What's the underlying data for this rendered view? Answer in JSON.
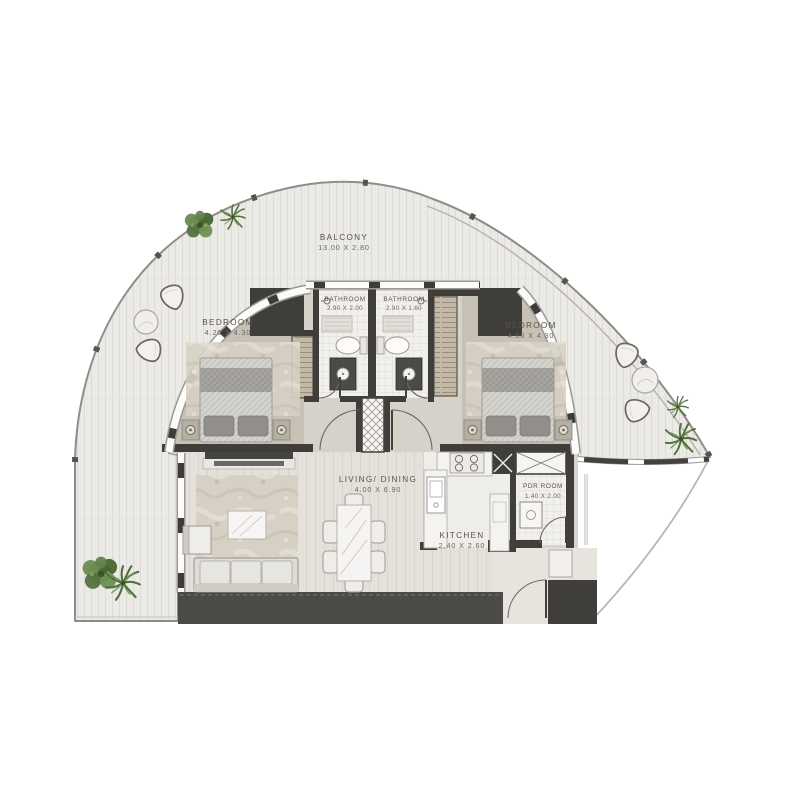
{
  "plan": {
    "rooms": [
      {
        "id": "balcony",
        "name": "BALCONY",
        "dims": "13.00 X 2.80"
      },
      {
        "id": "bedroom-left",
        "name": "BEDROOM",
        "dims": "4.20 X 4.30"
      },
      {
        "id": "bathroom-left",
        "name": "BATHROOM",
        "dims": "2.90 X 2.00"
      },
      {
        "id": "bathroom-right",
        "name": "BATHROOM",
        "dims": "2.90 X 1.60"
      },
      {
        "id": "bedroom-right",
        "name": "BEDROOM",
        "dims": "4.00 X 4.30"
      },
      {
        "id": "living-dining",
        "name": "LIVING/ DINING",
        "dims": "4.00 X 6.90"
      },
      {
        "id": "kitchen",
        "name": "KITCHEN",
        "dims": "2.40 X 2.60"
      },
      {
        "id": "pdr-room",
        "name": "PDR ROOM",
        "dims": "1.40 X 2.00"
      }
    ]
  },
  "colors": {
    "wall": "#3f3e3b",
    "outline": "#8f8d88",
    "label": "#57534d",
    "dims": "#6b6761",
    "floor-balcony": "#ebeae6",
    "floor-bedroom": "#c7c0b5",
    "floor-hall": "#d6d1c9",
    "floor-living": "#e4e1da",
    "floor-tile": "#f2f0ec",
    "floor-entry": "#e7e4de",
    "wardrobe": "#c4b9a6",
    "slab": "#4b4a47",
    "rug": "#d7d1c5",
    "plant": "#5d7a45"
  }
}
